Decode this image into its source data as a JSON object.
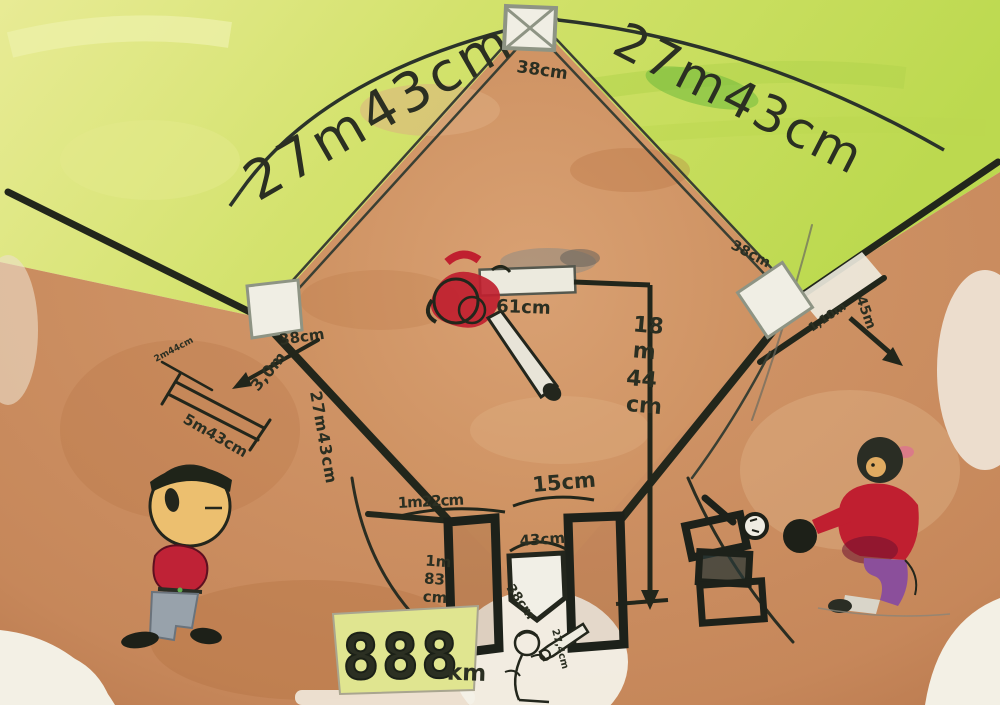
{
  "scene": {
    "description": "Child's watercolor painting of a baseball field diagram with measurements and three painted players",
    "colors": {
      "paper": "#f3f0e5",
      "outfield_yellow": "#e7ea92",
      "outfield_green": "#c6dd58",
      "grass_dark": "#8fc23c",
      "infield_tan": "#cd9164",
      "dirt_brown": "#bf8152",
      "ink": "#22261b",
      "base_white": "#f0eee4",
      "shirt_red": "#bf2132",
      "pants_gray": "#98a2ab",
      "pants_purple": "#8b4f9b",
      "skin": "#ecbf6f",
      "scoreboard_bg": "#e0e590"
    }
  },
  "labels": {
    "baseline_left": "27m43cm",
    "baseline_right": "27m43cm",
    "second_base_size": "38cm",
    "third_base_size": "38cm",
    "first_base_size": "38cm",
    "pitcher_plate_length": "61cm",
    "pitching_distance_lines": [
      "18",
      "m",
      "44",
      "cm"
    ],
    "home_to_third": "27m43cm",
    "third_line_width": "3,0m",
    "left_measure_long": "5m43cm",
    "left_measure_small": "2m44cm",
    "lane_width": "1,10m",
    "right_field_distance": "45m",
    "batter_box_width": "1m22cm",
    "boxes_gap": "15cm",
    "home_plate_width": "43cm",
    "home_plate_side": "38cm",
    "batter_box_depth_lines": [
      "1m",
      "83",
      "cm"
    ],
    "ball_size": "27,4cm",
    "scoreboard_digits": "888",
    "scoreboard_unit": "km"
  }
}
